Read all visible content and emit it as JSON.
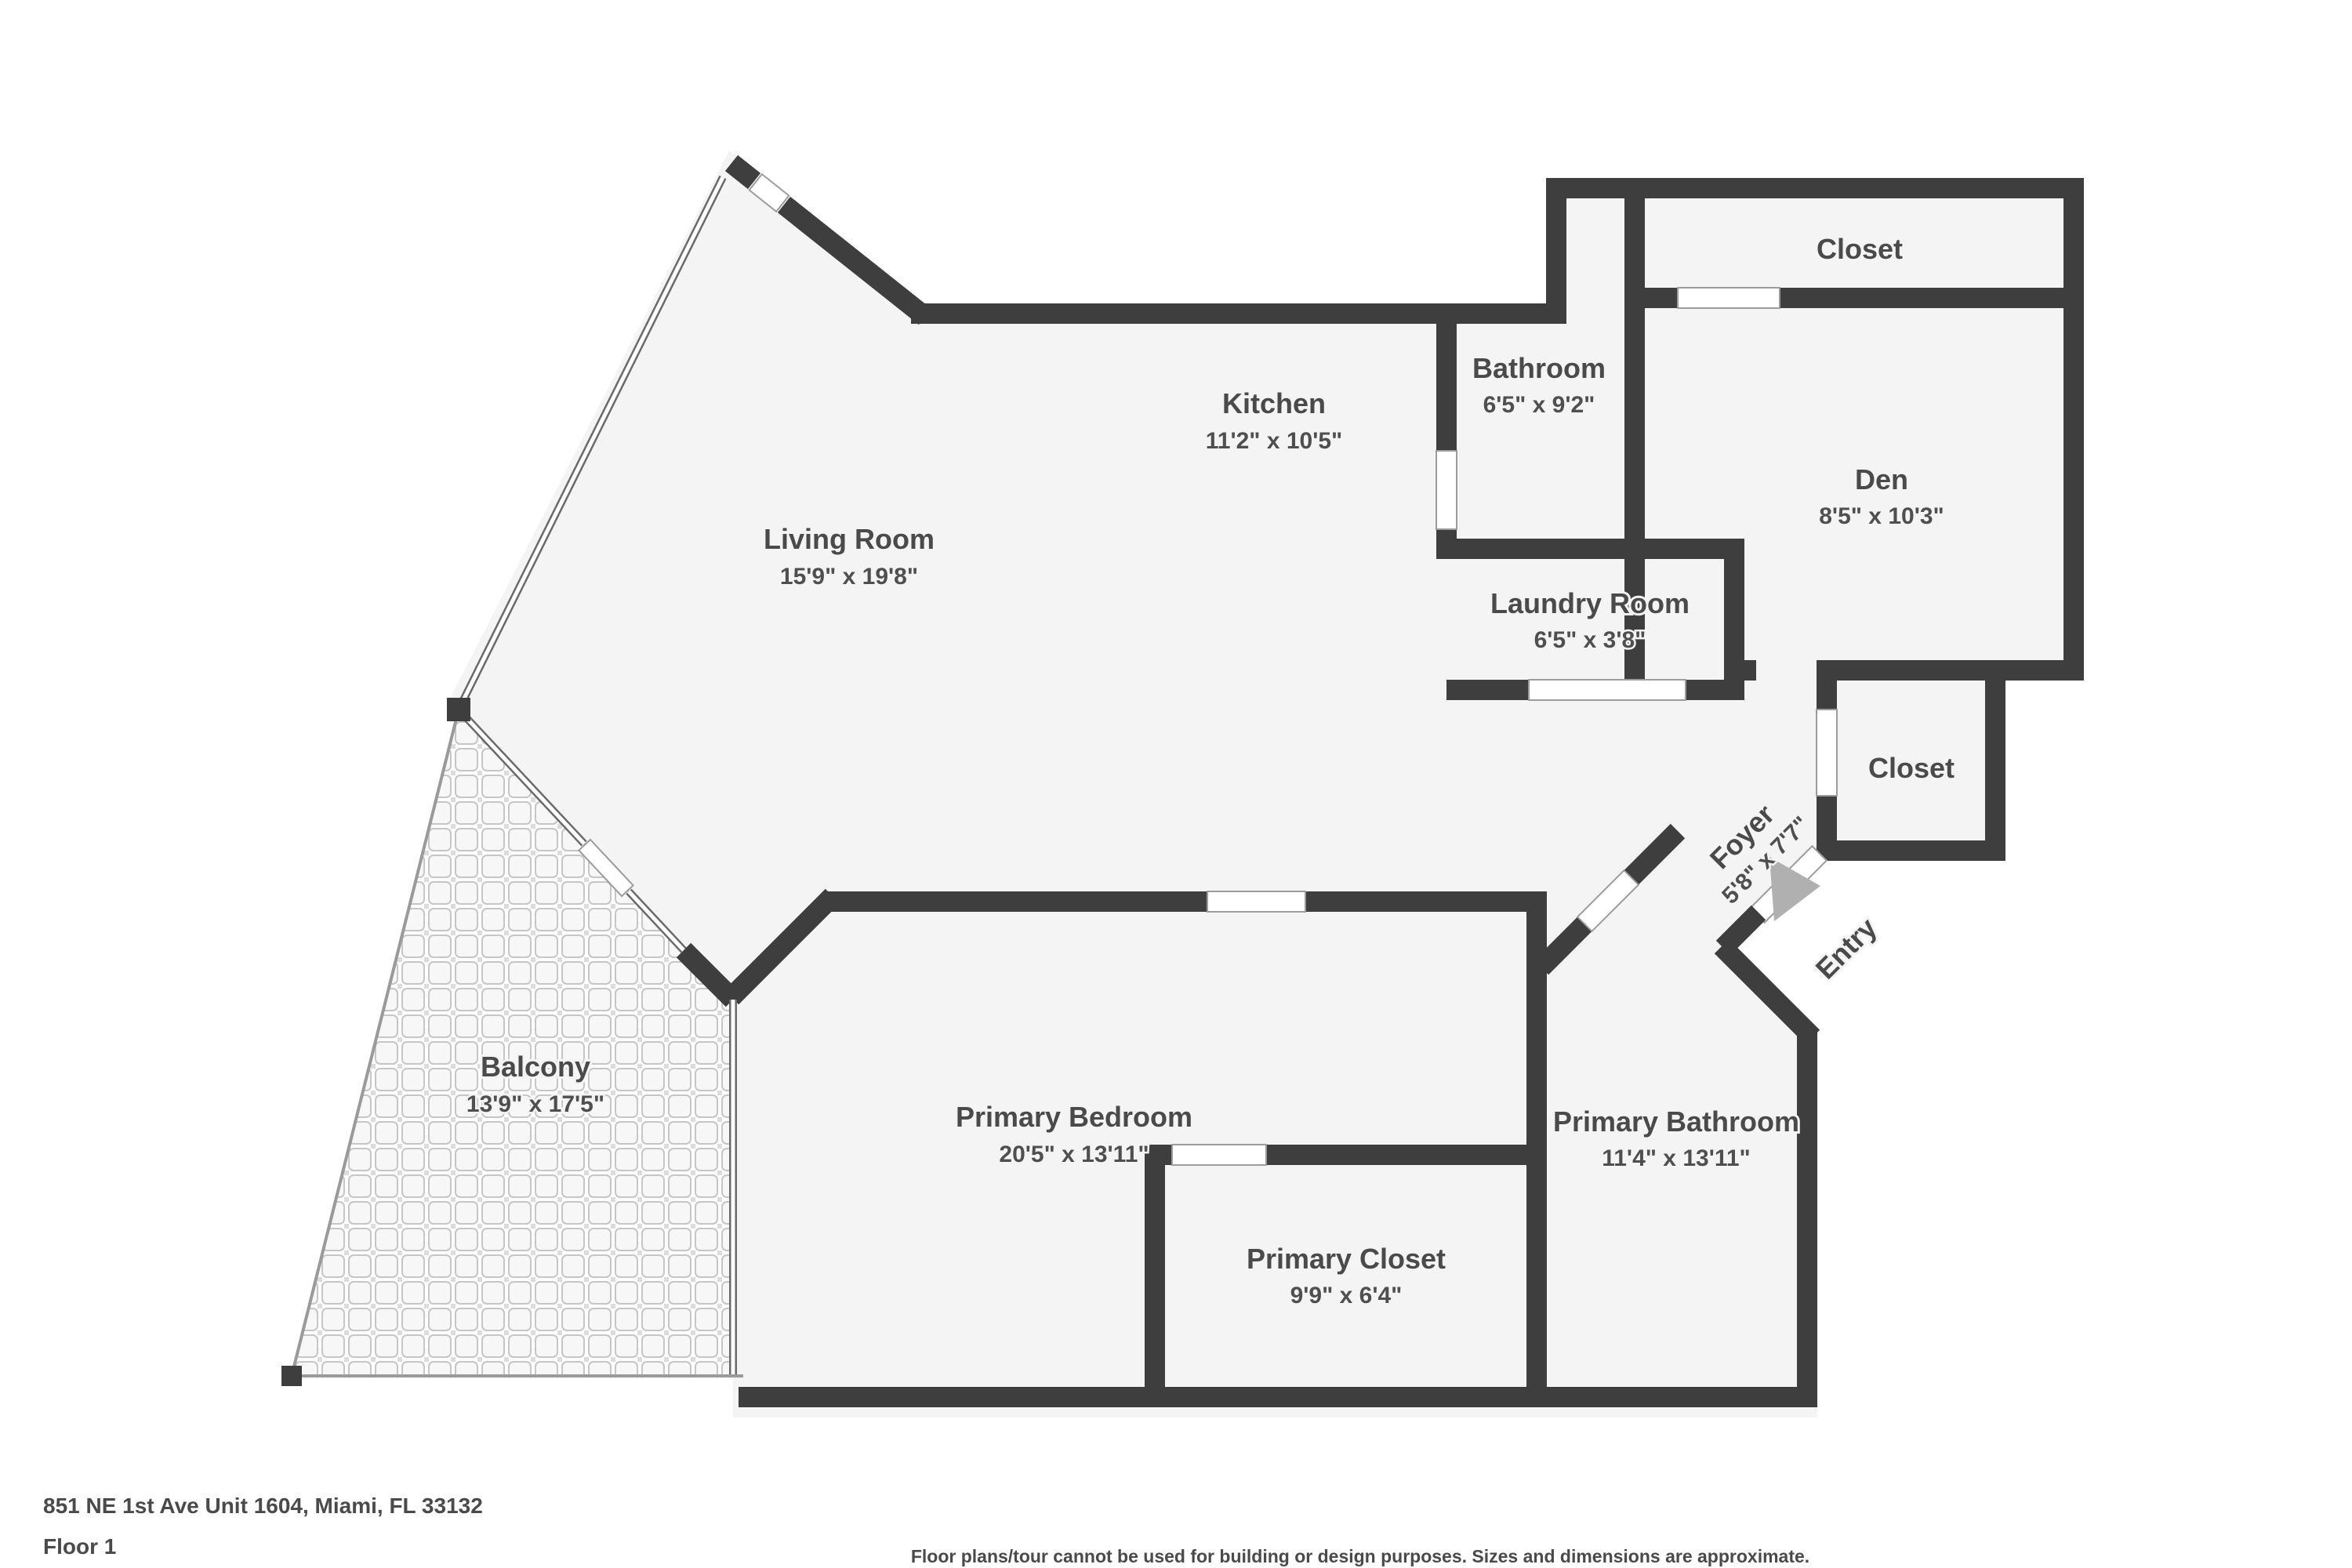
{
  "meta": {
    "address_line": "851 NE 1st Ave Unit 1604, Miami, FL 33132",
    "floor_label": "Floor 1",
    "disclaimer": "Floor plans/tour cannot be used for building or design purposes. Sizes and dimensions are approximate."
  },
  "colors": {
    "wall": "#3e3e3e",
    "floor": "#f4f4f4",
    "label_text": "#4a4a4a",
    "entry_arrow": "#b0b0b0",
    "background": "#ffffff"
  },
  "rooms": {
    "living_room": {
      "name": "Living Room",
      "dims": "15'9\" x 19'8\""
    },
    "kitchen": {
      "name": "Kitchen",
      "dims": "11'2\" x 10'5\""
    },
    "bathroom": {
      "name": "Bathroom",
      "dims": "6'5\" x 9'2\""
    },
    "closet_top": {
      "name": "Closet",
      "dims": ""
    },
    "den": {
      "name": "Den",
      "dims": "8'5\" x 10'3\""
    },
    "laundry_room": {
      "name": "Laundry Room",
      "dims": "6'5\" x 3'8\""
    },
    "closet_foyer": {
      "name": "Closet",
      "dims": ""
    },
    "foyer": {
      "name": "Foyer",
      "dims": "5'8\" x 7'7\""
    },
    "entry": {
      "name": "Entry",
      "dims": ""
    },
    "balcony": {
      "name": "Balcony",
      "dims": "13'9\" x 17'5\""
    },
    "primary_bedroom": {
      "name": "Primary Bedroom",
      "dims": "20'5\" x 13'11\""
    },
    "primary_bathroom": {
      "name": "Primary Bathroom",
      "dims": "11'4\" x 13'11\""
    },
    "primary_closet": {
      "name": "Primary Closet",
      "dims": "9'9\" x 6'4\""
    }
  }
}
